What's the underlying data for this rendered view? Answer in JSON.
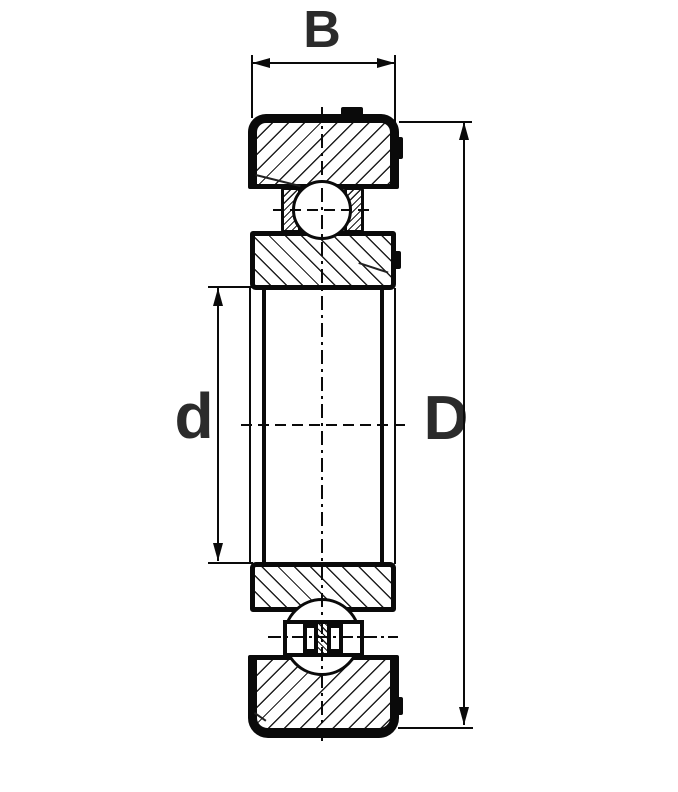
{
  "diagram": {
    "kind": "ball-bearing-cross-section",
    "labels": {
      "width": "B",
      "bore_diameter": "d",
      "outer_diameter": "D"
    },
    "colors": {
      "background": "#ffffff",
      "line": "#0a0a0a",
      "hatch": "#1f1f1f",
      "text": "#2b2b2b"
    }
  }
}
